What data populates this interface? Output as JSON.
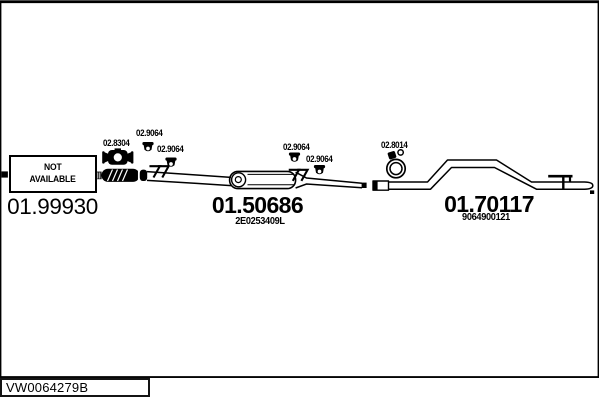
{
  "page": {
    "background": "#ffffff",
    "line_color": "#000000"
  },
  "drawing": {
    "front_section": {
      "availability_line1": "NOT",
      "availability_line2": "AVAILABLE",
      "part_number": "01.99930"
    },
    "center_muffler": {
      "part_number": "01.50686",
      "oem_number": "2E0253409L"
    },
    "rear_pipe": {
      "part_number": "01.70117",
      "oem_number": "9064900121"
    },
    "fittings": [
      {
        "label": "02.8304",
        "icon": "flange-clamp-icon"
      },
      {
        "label": "02.9064",
        "icon": "rubber-hanger-icon"
      },
      {
        "label": "02.9064",
        "icon": "rubber-hanger-icon"
      },
      {
        "label": "02.9064",
        "icon": "rubber-hanger-icon"
      },
      {
        "label": "02.9064",
        "icon": "rubber-hanger-icon"
      },
      {
        "label": "02.8014",
        "icon": "ring-clamp-icon"
      }
    ]
  },
  "footer": {
    "diagram_code": "VW0064279B"
  }
}
